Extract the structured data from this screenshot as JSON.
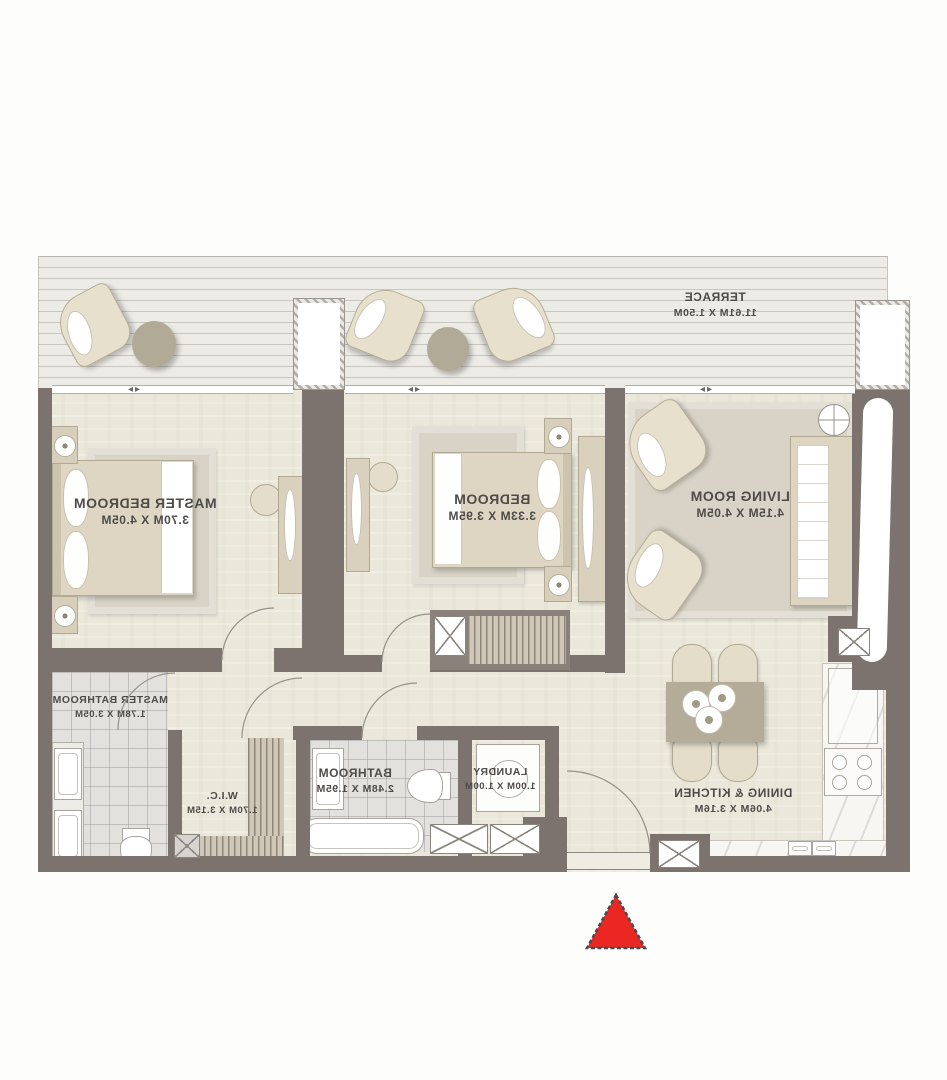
{
  "plan": {
    "type": "apartment-floor-plan",
    "text_mirrored": true,
    "rooms": [
      {
        "id": "terrace",
        "name": "TERRACE",
        "dims": "11.61M X 1.50M"
      },
      {
        "id": "master-bedroom",
        "name": "MASTER BEDROOM",
        "dims": "3.70M X 4.05M"
      },
      {
        "id": "bedroom",
        "name": "BEDROOM",
        "dims": "3.33M X 3.95M"
      },
      {
        "id": "living-room",
        "name": "LIVING ROOM",
        "dims": "4.15M X 4.05M"
      },
      {
        "id": "master-bathroom",
        "name": "MASTER BATHROOM",
        "dims": "1.78M X 3.05M"
      },
      {
        "id": "wic",
        "name": "W.I.C.",
        "dims": "1.70M X 3.15M"
      },
      {
        "id": "bathroom",
        "name": "BATHROOM",
        "dims": "2.48M X 1.95M"
      },
      {
        "id": "laundry",
        "name": "LAUNDRY",
        "dims": "1.00M X 1.00M"
      },
      {
        "id": "dining-kitchen",
        "name": "DINING & KITCHEN",
        "dims": "4.06M X 3.16M"
      }
    ],
    "colors": {
      "wall": "#7c736f",
      "floor": "#ebe7da",
      "furniture": "#ded6c3",
      "accent_table": "#b1aa97",
      "entrance_marker": "#ea2723",
      "label_text": "#4e4b48"
    },
    "icons": {
      "window_arrows": "◂▸"
    }
  }
}
